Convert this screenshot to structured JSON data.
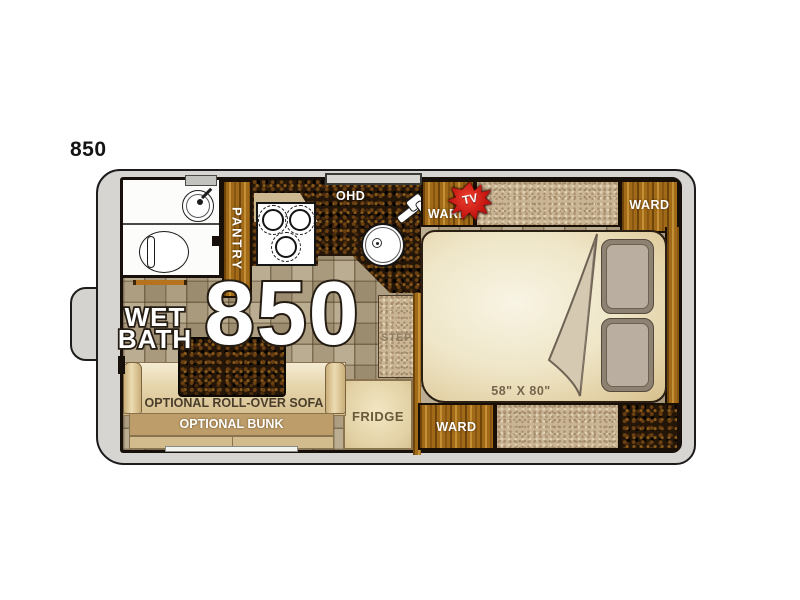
{
  "page": {
    "model_label": "850"
  },
  "floorplan": {
    "big_number": "850",
    "labels": {
      "wet_bath_line1": "WET",
      "wet_bath_line2": "BATH",
      "pantry": "PANTRY",
      "ohd": "OHD",
      "ward_top_left": "WARD",
      "tv": "TV",
      "ward_top_right": "WARD",
      "bed_size": "58\" X 80\"",
      "step": "STEP",
      "fridge": "FRIDGE",
      "ward_bottom": "WARD",
      "optional_sofa": "OPTIONAL ROLL-OVER SOFA",
      "optional_bunk": "OPTIONAL BUNK"
    },
    "colors": {
      "wood": "#a06a18",
      "dark_counter": "#231507",
      "tile_floor": "#b2a283",
      "bed_cream": "#f2ecd8",
      "sofa_tan": "#d9c193",
      "tv_red": "#c41510",
      "body_gray": "#d6d5d1"
    },
    "icons": {
      "toilet": "ellipse-with-tank-bar",
      "bathroom_sink": "round-basin",
      "kitchen_sink": "round-basin-with-faucet",
      "stove": "three-burner-cooktop",
      "tv_badge": "red-starburst",
      "blanket": "folded-corner"
    }
  }
}
